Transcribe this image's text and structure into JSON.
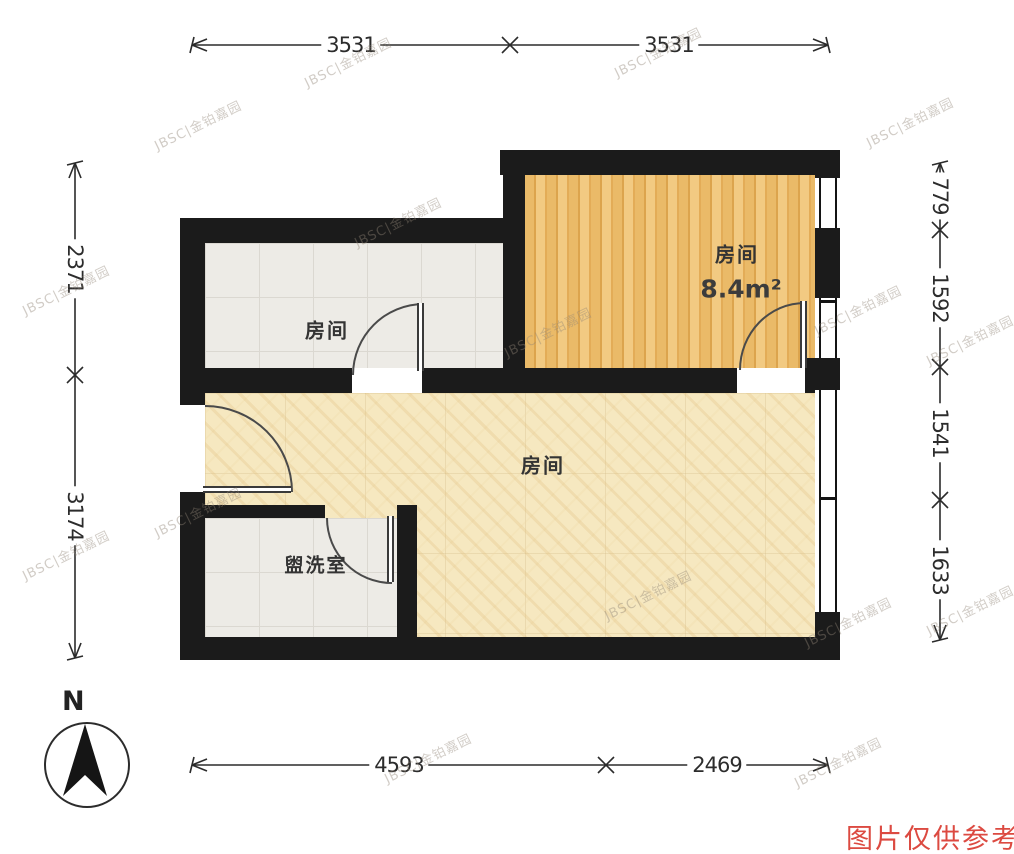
{
  "floorplan": {
    "rooms": [
      {
        "label": "房间"
      },
      {
        "label": "房间",
        "area": "8.4m²"
      },
      {
        "label": "房间"
      },
      {
        "label": "盥洗室"
      }
    ]
  },
  "dimensions": {
    "top": [
      "3531",
      "3531"
    ],
    "bottom": [
      "4593",
      "2469"
    ],
    "left": [
      "2371",
      "3174"
    ],
    "right": [
      "779",
      "1592",
      "1541",
      "1633"
    ]
  },
  "compass": {
    "north_label": "N"
  },
  "watermark": {
    "text": "JBSC|金铂嘉园"
  },
  "footnote": {
    "text": "图片仅供参考"
  },
  "colors": {
    "wall": "#1b1b1b",
    "wood_floor": "#ecbc6e",
    "marble_floor": "#f6e8c0",
    "tile_floor": "#edebe6",
    "note_red": "#dc4a41"
  }
}
